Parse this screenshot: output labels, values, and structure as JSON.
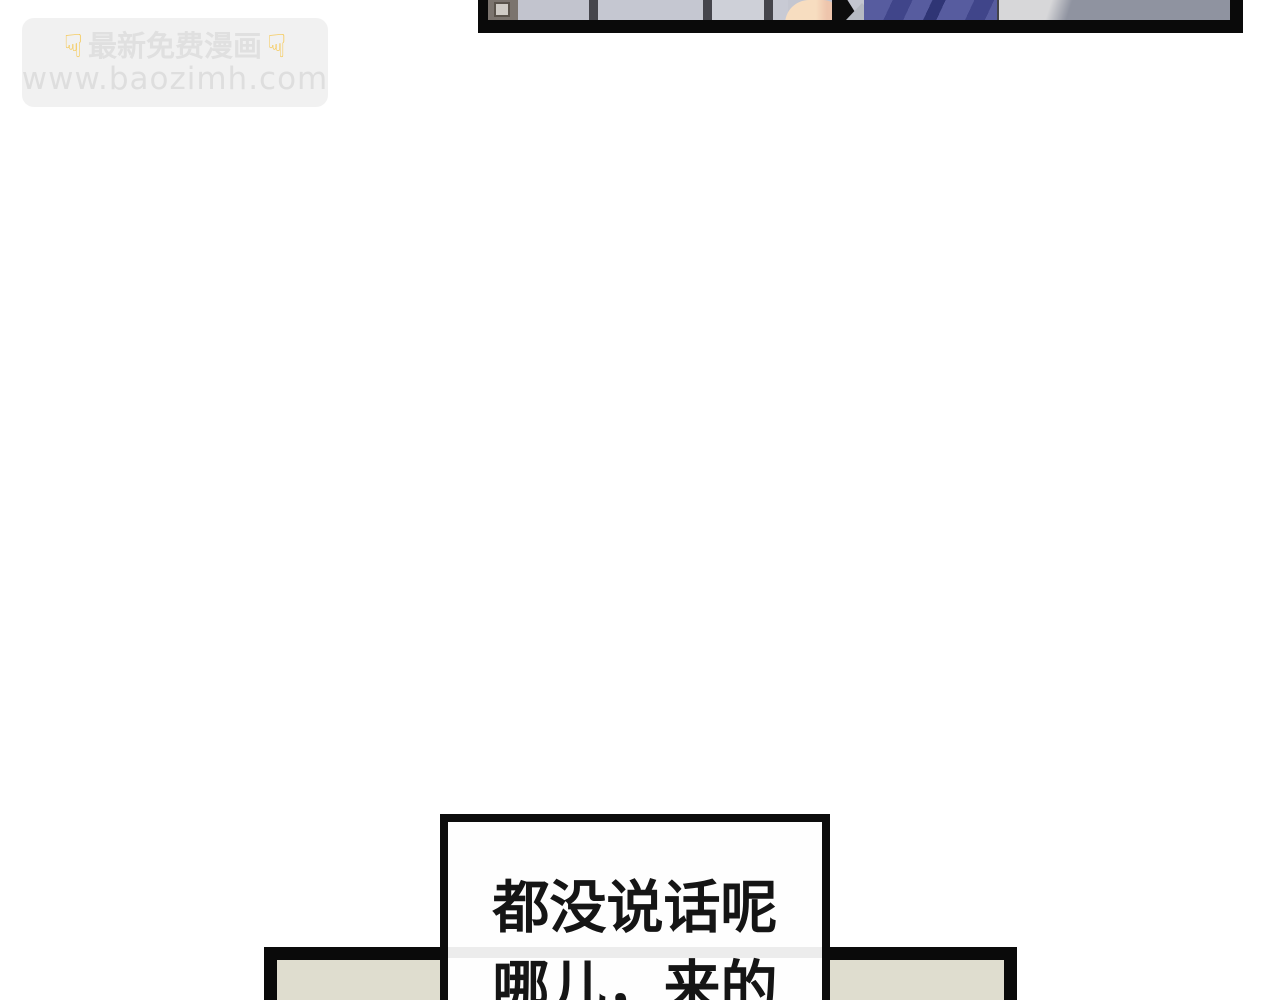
{
  "page": {
    "background_color": "#ffffff"
  },
  "watermark": {
    "emoji_icon": "point-down-emoji",
    "emoji_glyph": "☟",
    "emoji_color": "#f6c64b",
    "line1_text": "最新免费漫画",
    "line2_text": "www.baozimh.com",
    "bg_color": "#f1f1f1",
    "line1_color": "#e0e0e0",
    "line2_color": "#dedede"
  },
  "top_panel": {
    "border_color": "#0a0a0a",
    "wall_color": "#c4c6d0",
    "divider_color": "#45454c",
    "window_frame_color": "#7b746e",
    "window_pane_color": "#cfcbc5",
    "cell2_color": "#c2c4ce",
    "cell3_color": "#c5c7d1",
    "cell4_color": "#ced0d8",
    "cell5_color": "#c8cad4",
    "skin_gradient": "linear-gradient(90deg, #f7ddc0 0 55%, #eec5ac 75%)",
    "hair_color": "#0d0d0d",
    "collar_color": "#b6bac2",
    "jacket_pattern": "repeating-linear-gradient(115deg, #575c9f 0 26px, #40458a 26px 44px, #575c9f 44px 62px, #2f3575 62px 74px)",
    "wall_end_gradient": "linear-gradient(108deg, #d7d7d9 0 52px, #8f93a0 72px 100%)",
    "wall_end_edge_color": "#44444a"
  },
  "speech_bubble": {
    "line1": "都没说话呢",
    "line2": "哪儿，来的",
    "text_color": "#151515",
    "bg_color": "#fefefe",
    "border_color": "#0d0d0d",
    "stripe_color": "#dcdcdc"
  },
  "bottom_panel": {
    "bg_color": "#dfddcf",
    "border_color": "#0a0a0a"
  }
}
